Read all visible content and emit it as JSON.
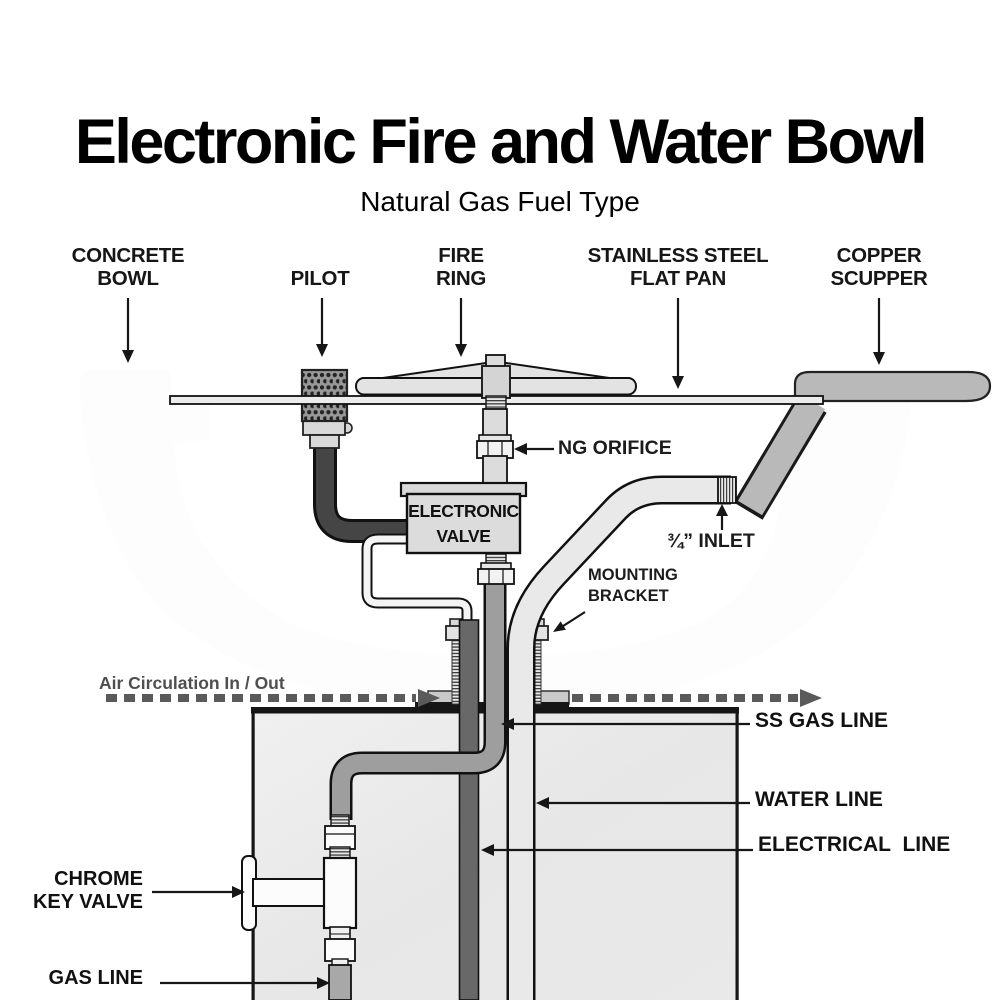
{
  "page": {
    "title": "Electronic Fire and Water Bowl",
    "subtitle": "Natural Gas Fuel Type"
  },
  "top_labels": [
    {
      "id": "concrete-bowl",
      "line1": "CONCRETE",
      "line2": "BOWL"
    },
    {
      "id": "pilot",
      "line1": "PILOT",
      "line2": ""
    },
    {
      "id": "fire-ring",
      "line1": "FIRE",
      "line2": "RING"
    },
    {
      "id": "flat-pan",
      "line1": "STAINLESS STEEL",
      "line2": "FLAT PAN"
    },
    {
      "id": "copper-scupper",
      "line1": "COPPER",
      "line2": "SCUPPER"
    }
  ],
  "annotations": {
    "ng_orifice": "NG ORIFICE",
    "inlet": "¾” INLET",
    "mounting_bracket": "MOUNTING\nBRACKET",
    "air_circulation": "Air Circulation In / Out",
    "ss_gas_line": "SS GAS LINE",
    "water_line": "WATER LINE",
    "electrical_line": "ELECTRICAL LINE",
    "chrome_key_valve_line1": "CHROME",
    "chrome_key_valve_line2": "KEY VALVE",
    "gas_line": "GAS LINE",
    "valve_line1": "ELECTRONIC",
    "valve_line2": "VALVE"
  },
  "colors": {
    "outline": "#1a1a1a",
    "concrete_dot": "#4a4a4a",
    "metal_gray": "#b9b9b9",
    "pipe_gray": "#9e9e9e",
    "conduit_gray": "#686868",
    "light_metal": "#e3e3e3",
    "pedestal_gray": "#e9e9e9",
    "air_label_gray": "#555555"
  }
}
